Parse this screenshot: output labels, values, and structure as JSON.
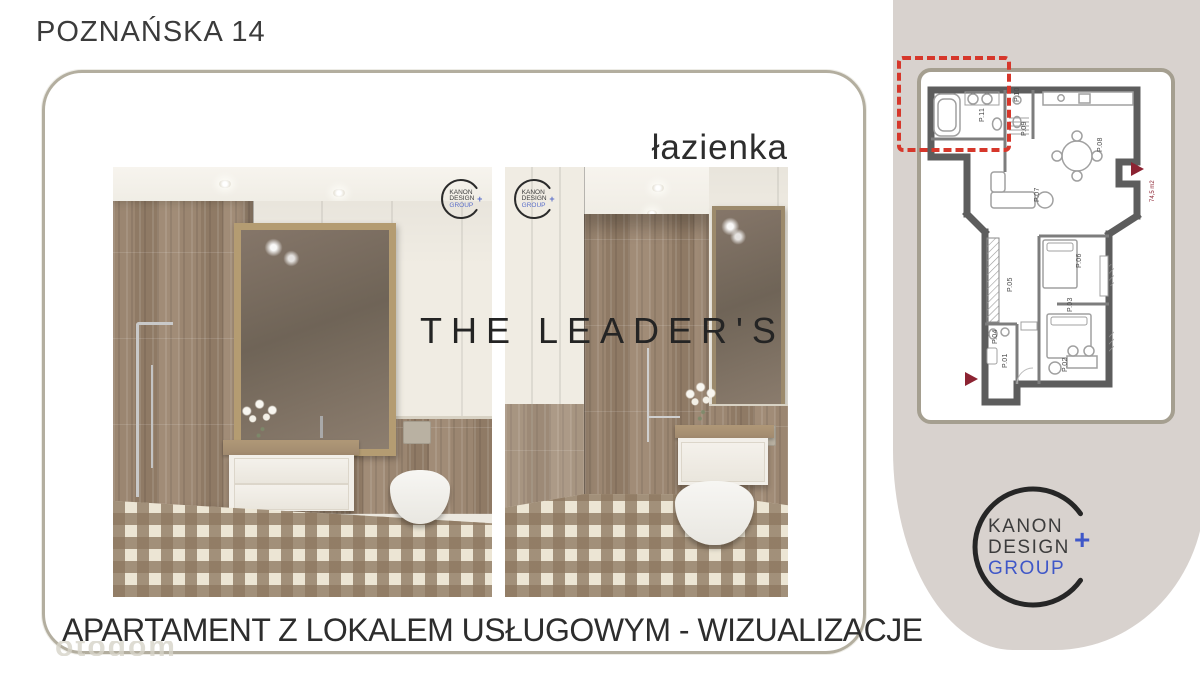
{
  "header": {
    "title": "POZNAŃSKA 14"
  },
  "gallery": {
    "section_label": "łazienka",
    "brand_watermark": "THE LEADER'S"
  },
  "footer": {
    "title": "APARTAMENT Z LOKALEM USŁUGOWYM - WIZUALIZACJE",
    "portal_watermark": "otodom"
  },
  "logo": {
    "line1": "KANON",
    "line2": "DESIGN",
    "line3": "GROUP",
    "plus": "+"
  },
  "floorplan": {
    "area_note": "74,5 m2",
    "rooms": [
      {
        "id": "P.11",
        "x": 63,
        "y": 50
      },
      {
        "id": "P.10",
        "x": 98,
        "y": 30
      },
      {
        "id": "P.09",
        "x": 105,
        "y": 64
      },
      {
        "id": "P.08",
        "x": 181,
        "y": 80
      },
      {
        "id": "P.07",
        "x": 118,
        "y": 130
      },
      {
        "id": "P.06",
        "x": 160,
        "y": 196
      },
      {
        "id": "P.05",
        "x": 91,
        "y": 220
      },
      {
        "id": "P.03",
        "x": 151,
        "y": 240
      },
      {
        "id": "P.04",
        "x": 76,
        "y": 272
      },
      {
        "id": "P.01",
        "x": 86,
        "y": 296
      },
      {
        "id": "P.02",
        "x": 146,
        "y": 300
      }
    ]
  },
  "colors": {
    "accent_red": "#d6372b",
    "logo_blue": "#3f57c8",
    "panel_beige": "#d8d2ce",
    "frame_border": "#b3ae9f",
    "plan_marker_red": "#8c2332",
    "wall_gray": "#5d5d5d"
  }
}
